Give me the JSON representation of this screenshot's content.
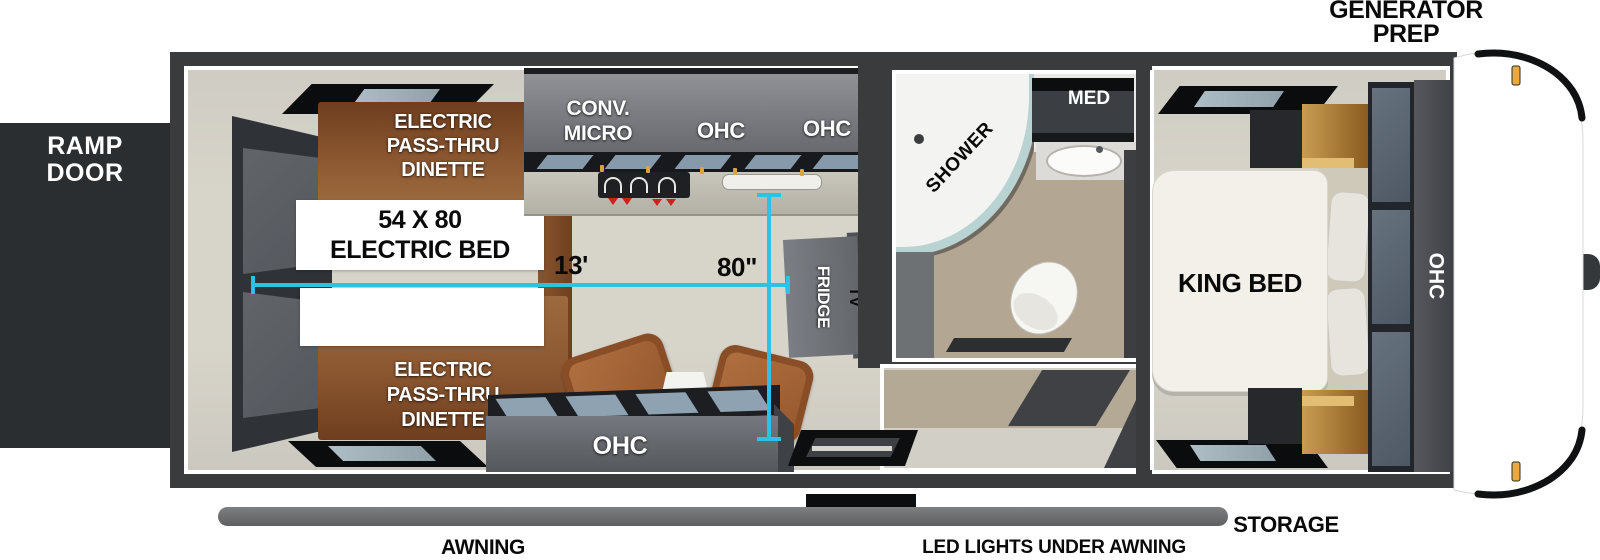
{
  "exterior": {
    "generator_prep": {
      "line1": "GENERATOR",
      "line2": "PREP"
    },
    "ramp_door": {
      "line1": "RAMP",
      "line2": "DOOR"
    },
    "awning": "AWNING",
    "led_lights": "LED LIGHTS UNDER AWNING",
    "storage": "STORAGE"
  },
  "garage": {
    "dinette_top": {
      "line1": "ELECTRIC",
      "line2": "PASS-THRU",
      "line3": "DINETTE"
    },
    "dinette_bottom": {
      "line1": "ELECTRIC",
      "line2": "PASS-THRU",
      "line3": "DINETTE"
    },
    "electric_bed": {
      "line1": "54 X 80",
      "line2": "ELECTRIC BED"
    }
  },
  "kitchen": {
    "conv_micro": {
      "line1": "CONV.",
      "line2": "MICRO"
    },
    "ohc_left": "OHC",
    "ohc_right": "OHC",
    "fridge": "FRIDGE",
    "tv": "TV"
  },
  "living": {
    "ohc": "OHC"
  },
  "bathroom": {
    "shower": "SHOWER",
    "med": "MED"
  },
  "bedroom": {
    "king_bed": "KING BED",
    "ohc": "OHC"
  },
  "dimensions": {
    "garage_length": "13'",
    "bed_width": "80\""
  },
  "colors": {
    "dimension_cyan": "#29c3e8",
    "wall_gray": "#3a3b3d",
    "floor_beige": "#d7d4ca",
    "dinette_brown": "#8a5630",
    "cabinet_gray": "#75777c",
    "awning_gray": "#6e7072",
    "marker_amber": "#eaa83e",
    "ramp_black": "#2b2e30"
  }
}
